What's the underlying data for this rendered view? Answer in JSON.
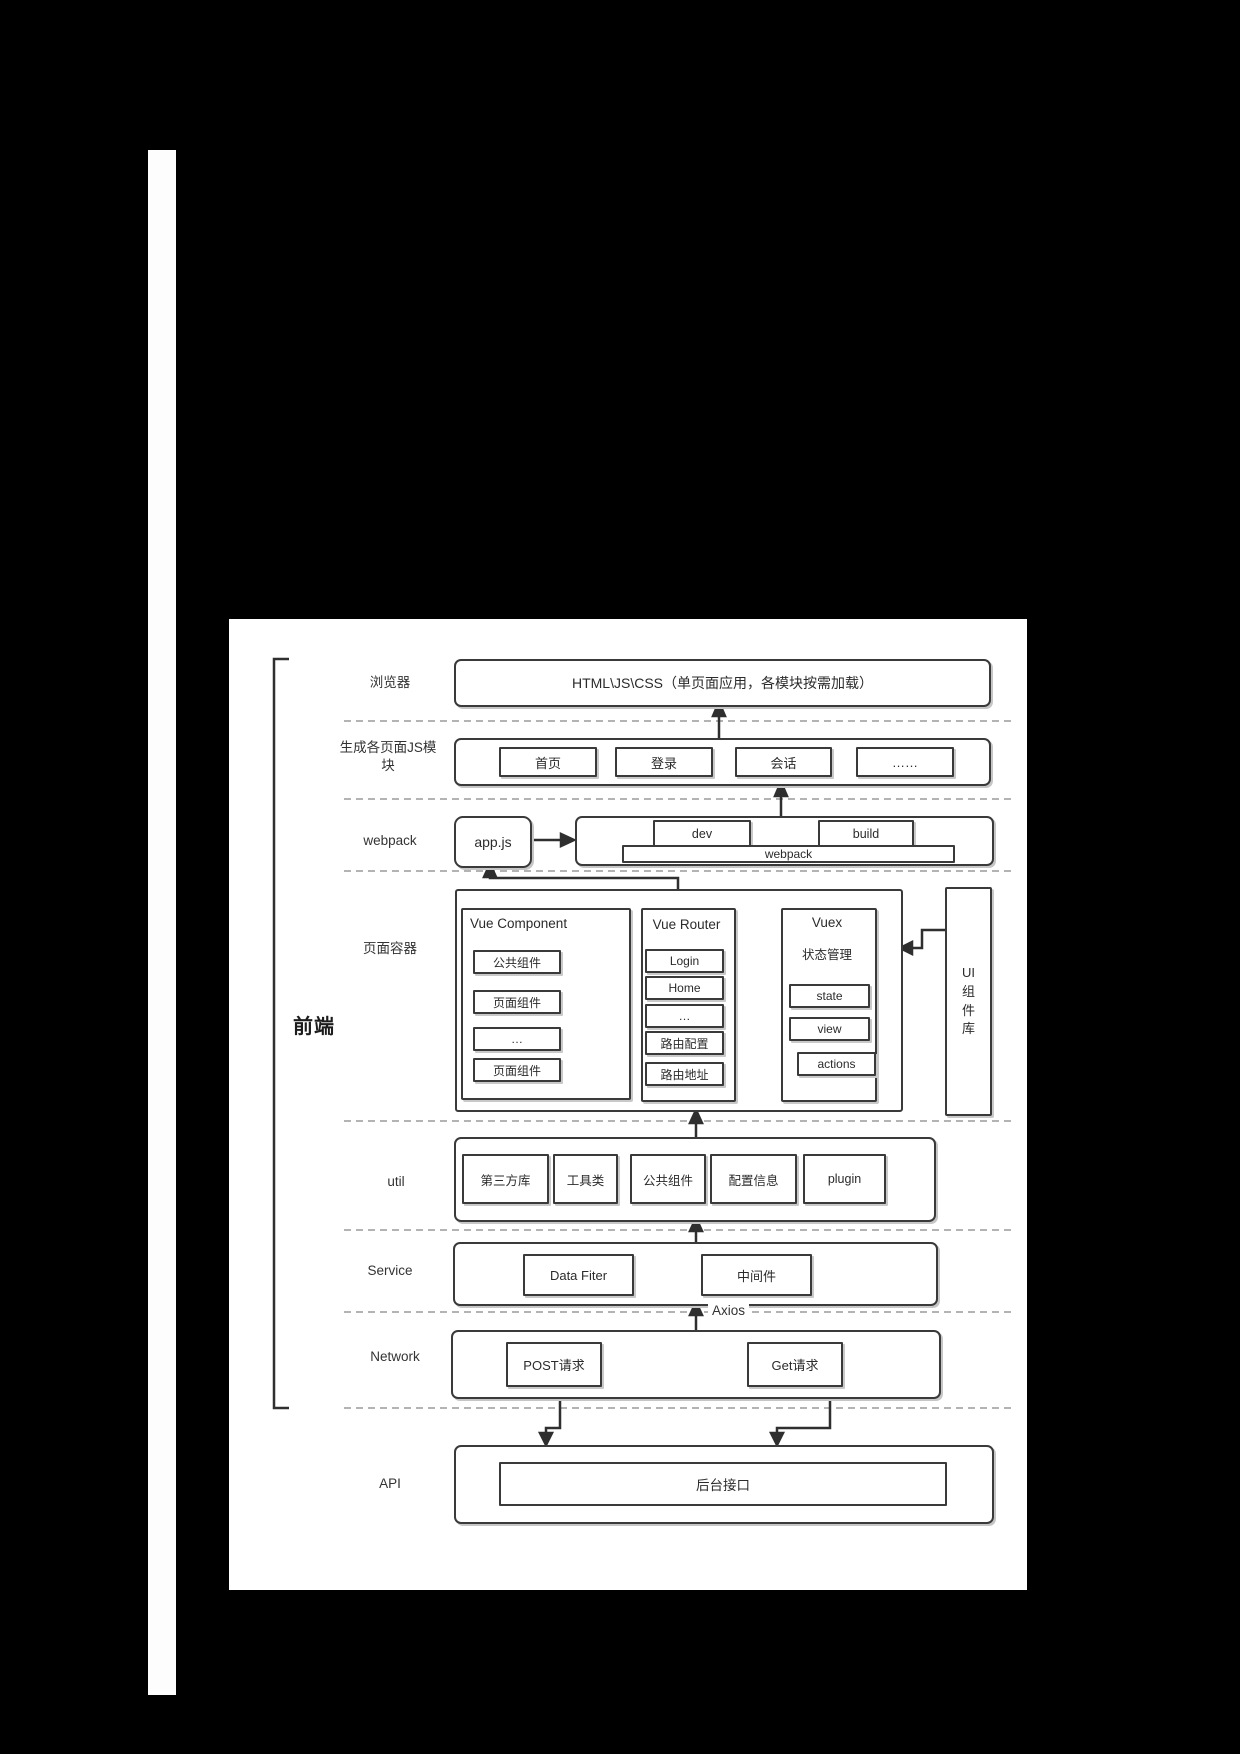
{
  "page": {
    "bracket_label": "前端"
  },
  "rows": {
    "browser": {
      "label": "浏览器",
      "content": "HTML\\JS\\CSS（单页面应用，各模块按需加载）"
    },
    "modules": {
      "label": "生成各页面JS模块",
      "items": [
        "首页",
        "登录",
        "会话",
        "……"
      ]
    },
    "webpack": {
      "label": "webpack",
      "app_js": "app.js",
      "dev": "dev",
      "build": "build",
      "bar": "webpack"
    },
    "container": {
      "label": "页面容器",
      "vue_component": {
        "title": "Vue Component",
        "items": [
          "公共组件",
          "页面组件",
          "…",
          "页面组件"
        ]
      },
      "vue_router": {
        "title": "Vue Router",
        "items": [
          "Login",
          "Home",
          "…",
          "路由配置",
          "路由地址"
        ]
      },
      "vuex": {
        "title": "Vuex",
        "subtitle": "状态管理",
        "items": [
          "state",
          "view",
          "actions"
        ]
      },
      "ui_library": "UI组件库"
    },
    "util": {
      "label": "util",
      "items": [
        "第三方库",
        "工具类",
        "公共组件",
        "配置信息",
        "plugin"
      ]
    },
    "service": {
      "label": "Service",
      "items": [
        "Data Fiter",
        "中间件"
      ]
    },
    "network": {
      "label": "Network",
      "axios": "Axios",
      "items": [
        "POST请求",
        "Get请求"
      ]
    },
    "api": {
      "label": "API",
      "content": "后台接口"
    }
  },
  "colors": {
    "background": "#000000",
    "paper": "#ffffff",
    "line": "#2f2f2f",
    "dashed": "#9a9a9a"
  }
}
